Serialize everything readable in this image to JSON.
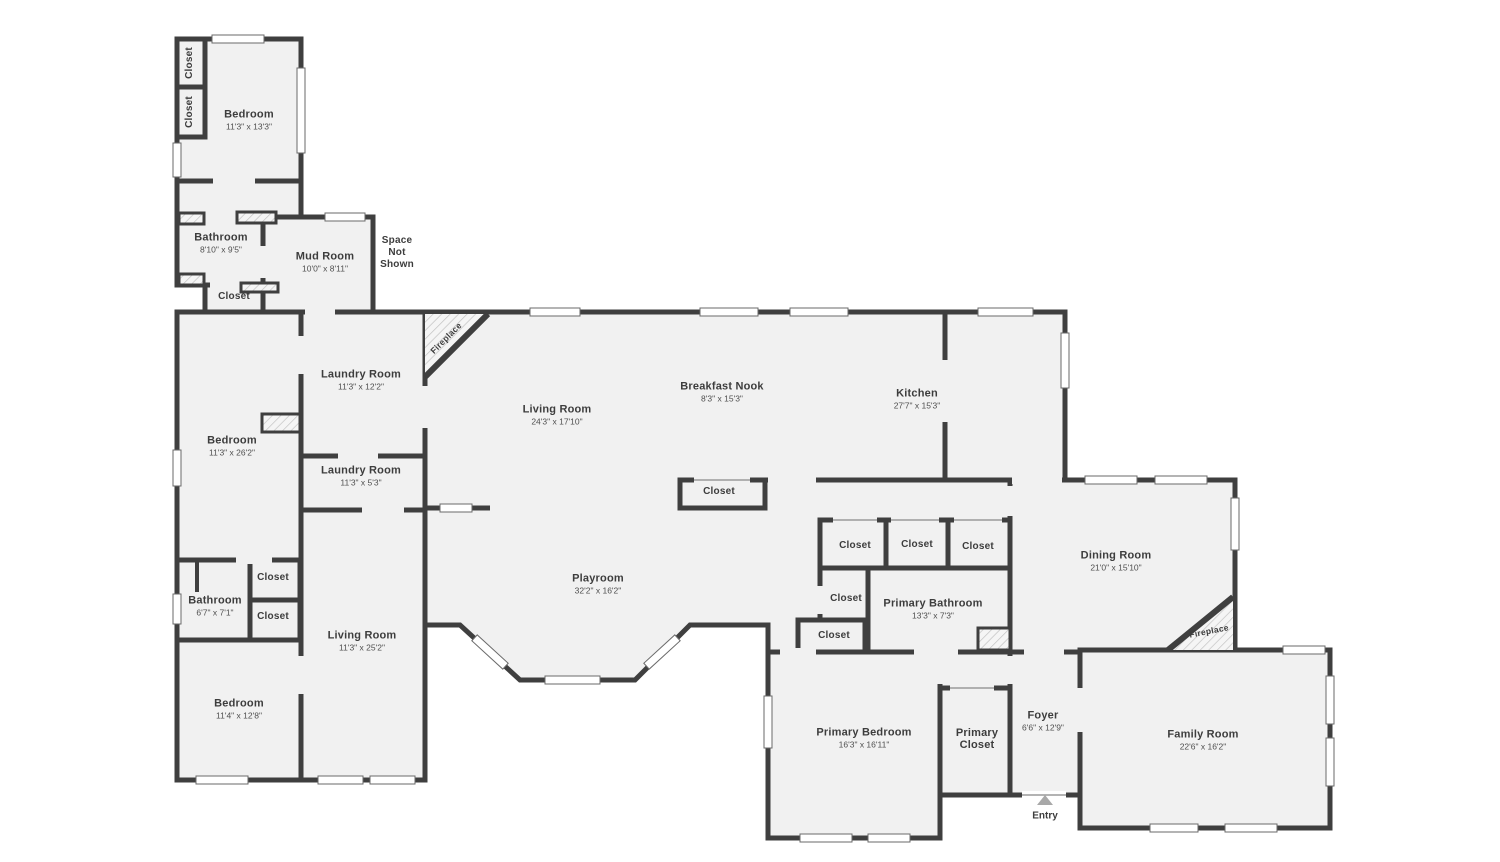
{
  "palette": {
    "wall": "#3f3f3f",
    "room_fill": "#f1f1f1",
    "background": "#ffffff",
    "label_text": "#3d3d3d",
    "dim_text": "#4f4f4f",
    "window_fill": "#ffffff",
    "hatch_line": "#c3c3c3",
    "entry_arrow": "#a8a8a8"
  },
  "rooms": {
    "bedroom1": {
      "name": "Bedroom",
      "dims": "11'3\" x 13'3\""
    },
    "bathroom1": {
      "name": "Bathroom",
      "dims": "8'10\" x 9'5\""
    },
    "mudroom": {
      "name": "Mud Room",
      "dims": "10'0\" x 8'11\""
    },
    "laundry1": {
      "name": "Laundry Room",
      "dims": "11'3\" x 12'2\""
    },
    "living1": {
      "name": "Living Room",
      "dims": "24'3\" x 17'10\""
    },
    "nook": {
      "name": "Breakfast Nook",
      "dims": "8'3\" x 15'3\""
    },
    "kitchen": {
      "name": "Kitchen",
      "dims": "27'7\" x 15'3\""
    },
    "bedroom2": {
      "name": "Bedroom",
      "dims": "11'3\" x 26'2\""
    },
    "laundry2": {
      "name": "Laundry Room",
      "dims": "11'3\" x 5'3\""
    },
    "dining": {
      "name": "Dining Room",
      "dims": "21'0\" x 15'10\""
    },
    "bathroom2": {
      "name": "Bathroom",
      "dims": "6'7\" x 7'1\""
    },
    "playroom": {
      "name": "Playroom",
      "dims": "32'2\" x 16'2\""
    },
    "pbath": {
      "name": "Primary Bathroom",
      "dims": "13'3\" x 7'3\""
    },
    "living2": {
      "name": "Living Room",
      "dims": "11'3\" x 25'2\""
    },
    "bedroom3": {
      "name": "Bedroom",
      "dims": "11'4\" x 12'8\""
    },
    "pbed": {
      "name": "Primary Bedroom",
      "dims": "16'3\" x 16'11\""
    },
    "foyer": {
      "name": "Foyer",
      "dims": "6'6\" x 12'9\""
    },
    "family": {
      "name": "Family Room",
      "dims": "22'6\" x 16'2\""
    }
  },
  "closets": [
    "Closet",
    "Closet",
    "Closet",
    "Closet",
    "Closet",
    "Closet",
    "Closet",
    "Closet",
    "Closet",
    "Closet",
    "Closet"
  ],
  "primary_closet": {
    "line1": "Primary",
    "line2": "Closet"
  },
  "fireplaces": [
    "Fireplace",
    "Fireplace"
  ],
  "space_not_shown": [
    "Space",
    "Not",
    "Shown"
  ],
  "entry_label": "Entry"
}
